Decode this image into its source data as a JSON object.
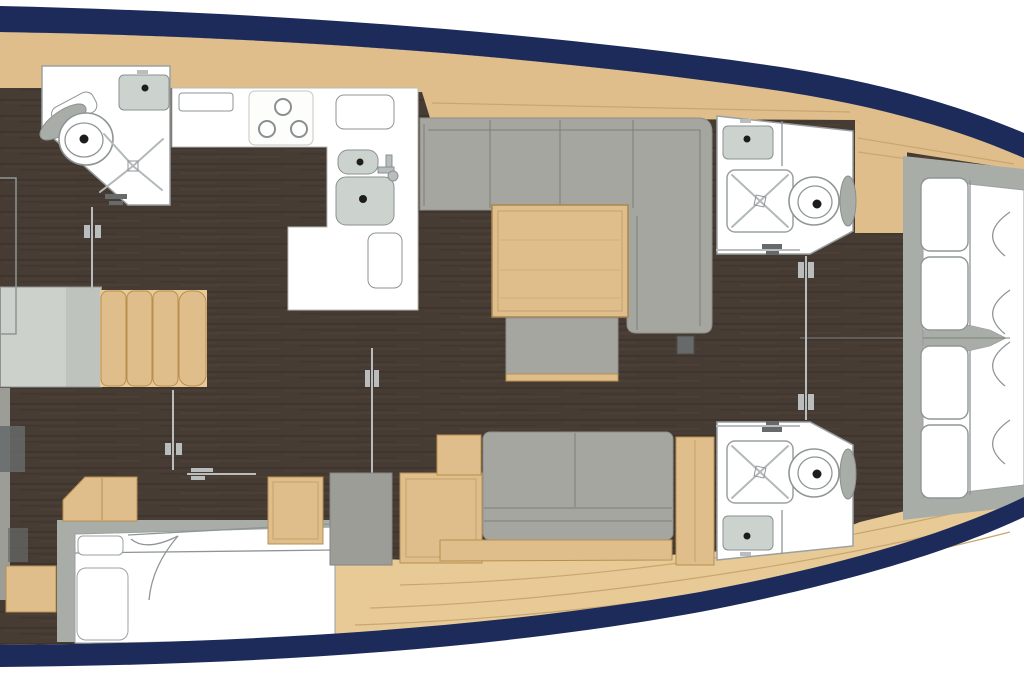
{
  "meta": {
    "title": "Sailing yacht interior floor plan — top-down view, bow to the right",
    "diagram_type": "boat-floor-plan",
    "orientation": "bow-right"
  },
  "palette": {
    "hull_navy": "#1d2b5b",
    "floor_dark": "#473c34",
    "floor_grain_dark": "#382f28",
    "floor_grain_light": "#5a4d40",
    "wood": "#e0be8b",
    "wood_edge": "#b7904f",
    "wood_floor": "#e7ca96",
    "wood_floor_line": "#c9a671",
    "sofa_gray": "#a6a6a1",
    "sofa_line": "#7e7e79",
    "frame_gray": "#a9ada8",
    "cabinet_gray": "#9d9d98",
    "platform_gray": "#cdd1cb",
    "platform_gray_2": "#bfc3bd",
    "white": "#ffffff",
    "fixture_line": "#8f9595",
    "sink_gray": "#ccd3cf",
    "hardware": "#b9bdbd",
    "hardware_dark": "#666a6a",
    "dot": "#1d1d1d",
    "page": "#ffffff"
  },
  "rooms": {
    "aft_cabin": {
      "label": "Aft cabin (port) with double berth"
    },
    "aft_head": {
      "label": "Aft head with basin, toilet and shower"
    },
    "companionway": {
      "label": "Companionway steps and landing"
    },
    "galley": {
      "label": "L-shaped galley with stove and twin sinks"
    },
    "saloon": {
      "label": "Saloon with L-settee, table and bench"
    },
    "starboard_settee": {
      "label": "Starboard settee with stowage cabinets"
    },
    "forward_head_port": {
      "label": "Forward head, port side (shower, toilet, basin)"
    },
    "forward_head_starboard": {
      "label": "Forward head, starboard side (shower, toilet, basin)"
    },
    "owners_cabin": {
      "label": "Forward owner's cabin with island berth"
    }
  },
  "fixtures": {
    "stove_burners": 3,
    "toilets": 3,
    "showers": 3,
    "sinks": 5,
    "berths": 2,
    "companionway_steps": 4
  }
}
